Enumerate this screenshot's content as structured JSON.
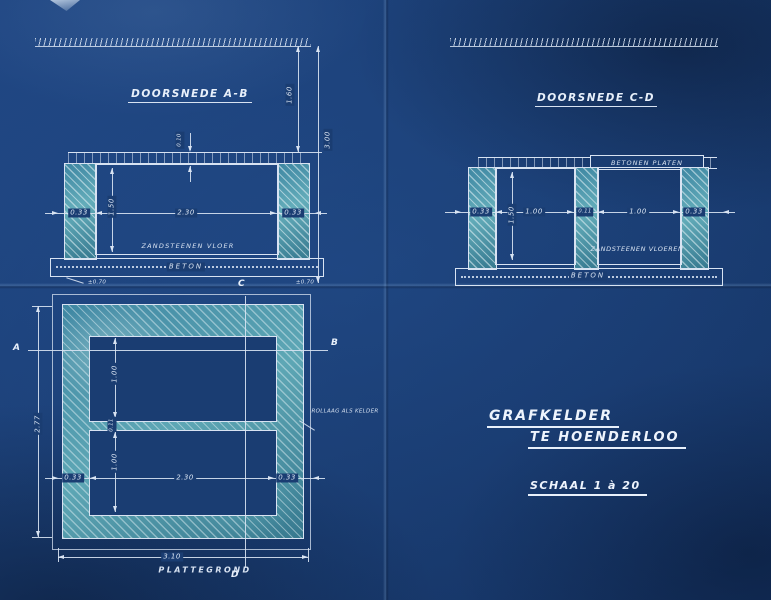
{
  "sheet": {
    "paper_color": "#1a3d72",
    "line_color": "#d8e3f2",
    "hatch_color": "#4f9ab0"
  },
  "section_ab": {
    "title": "DOORSNEDE A-B",
    "floor_label": "ZANDSTEENEN VLOER",
    "foundation_label": "BETON",
    "dim_slab": "0.10",
    "dim_wall_left": "0.33",
    "dim_inner_width": "2.30",
    "dim_wall_right": "0.33",
    "dim_inner_height": "1.50",
    "dim_ground_to_top": "1.60",
    "dim_total_depth": "3.00",
    "note_left": "±0.70",
    "note_right": "±0.70"
  },
  "section_cd": {
    "title": "DOORSNEDE C-D",
    "deck_label": "BETONEN PLATEN",
    "floor_label": "ZANDSTEENEN VLOEREN",
    "foundation_label": "BETON",
    "dim_wall_left": "0.33",
    "dim_chamber_left": "1.00",
    "dim_wall_mid": "0.11",
    "dim_chamber_right": "1.00",
    "dim_wall_right": "0.33",
    "dim_inner_height": "1.50"
  },
  "plan": {
    "title": "PLATTEGROND",
    "marker_a": "A",
    "marker_b": "B",
    "marker_c": "C",
    "marker_d": "D",
    "dim_chamber_top": "1.00",
    "dim_mid_wall": "0.11",
    "dim_chamber_bottom": "1.00",
    "dim_wall_left": "0.33",
    "dim_inner_width": "2.30",
    "dim_wall_right": "0.33",
    "dim_total_width": "3.10",
    "dim_total_height": "2.77",
    "note": "ROLLAAG ALS KELDER"
  },
  "title_block": {
    "line1": "GRAFKELDER",
    "line2": "TE HOENDERLOO",
    "scale": "SCHAAL 1 à 20"
  }
}
